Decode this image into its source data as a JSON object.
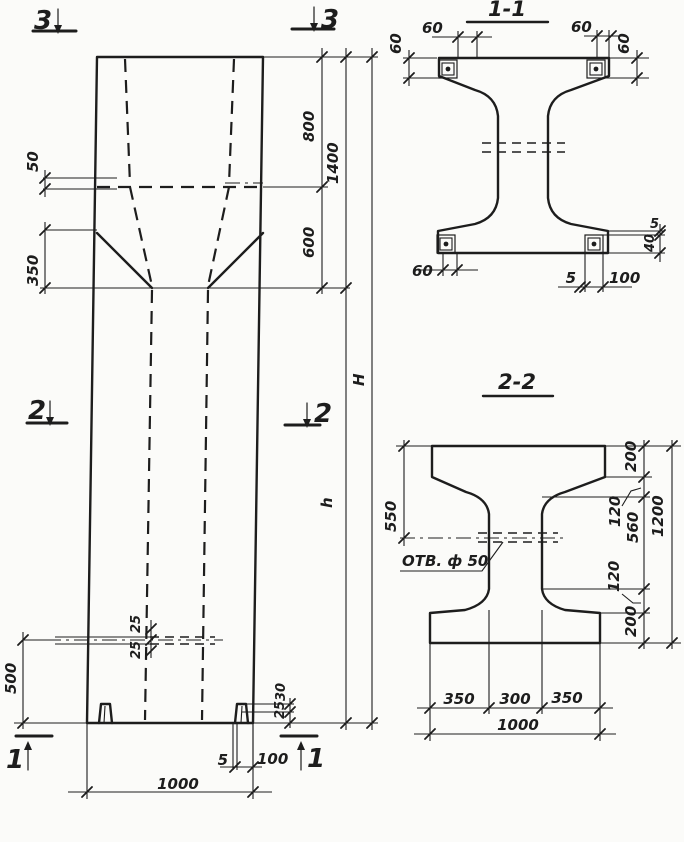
{
  "palette": {
    "ink": "#1d1d1d",
    "paper": "#fbfbf9"
  },
  "elevation": {
    "markers": {
      "top": "3",
      "middle": "2",
      "bottom": "1"
    },
    "dims": {
      "ledge_offset": "50",
      "chamfer": "350",
      "head_upper": "800",
      "head_total": "1400",
      "taper": "600",
      "total_height": "H",
      "shaft_height": "h",
      "hole_upper": "25",
      "hole_lower": "25",
      "hole_to_base": "500",
      "foot_upper": "30",
      "foot_lower": "25",
      "base_plate_thickness": "5",
      "base_plate_width": "100",
      "column_width": "1000"
    }
  },
  "section_1_1": {
    "title": "1-1",
    "dims": {
      "top_left_offset": "60",
      "top_left_depth": "60",
      "top_right_offset": "60",
      "top_right_depth": "60",
      "bottom_left_offset": "60",
      "plate_gap": "5",
      "plate_width": "100",
      "plate_edge": "5",
      "plate_height": "40"
    }
  },
  "section_2_2": {
    "title": "2-2",
    "hole_label": "ОТВ. ф 50",
    "dims": {
      "top_to_hole": "550",
      "top_flange": "200",
      "web_upper": "120",
      "web_middle": "560",
      "web_lower": "120",
      "bottom_flange": "200",
      "section_height": "1200",
      "flange_left": "350",
      "web_width": "300",
      "flange_right": "350",
      "section_width": "1000"
    }
  }
}
